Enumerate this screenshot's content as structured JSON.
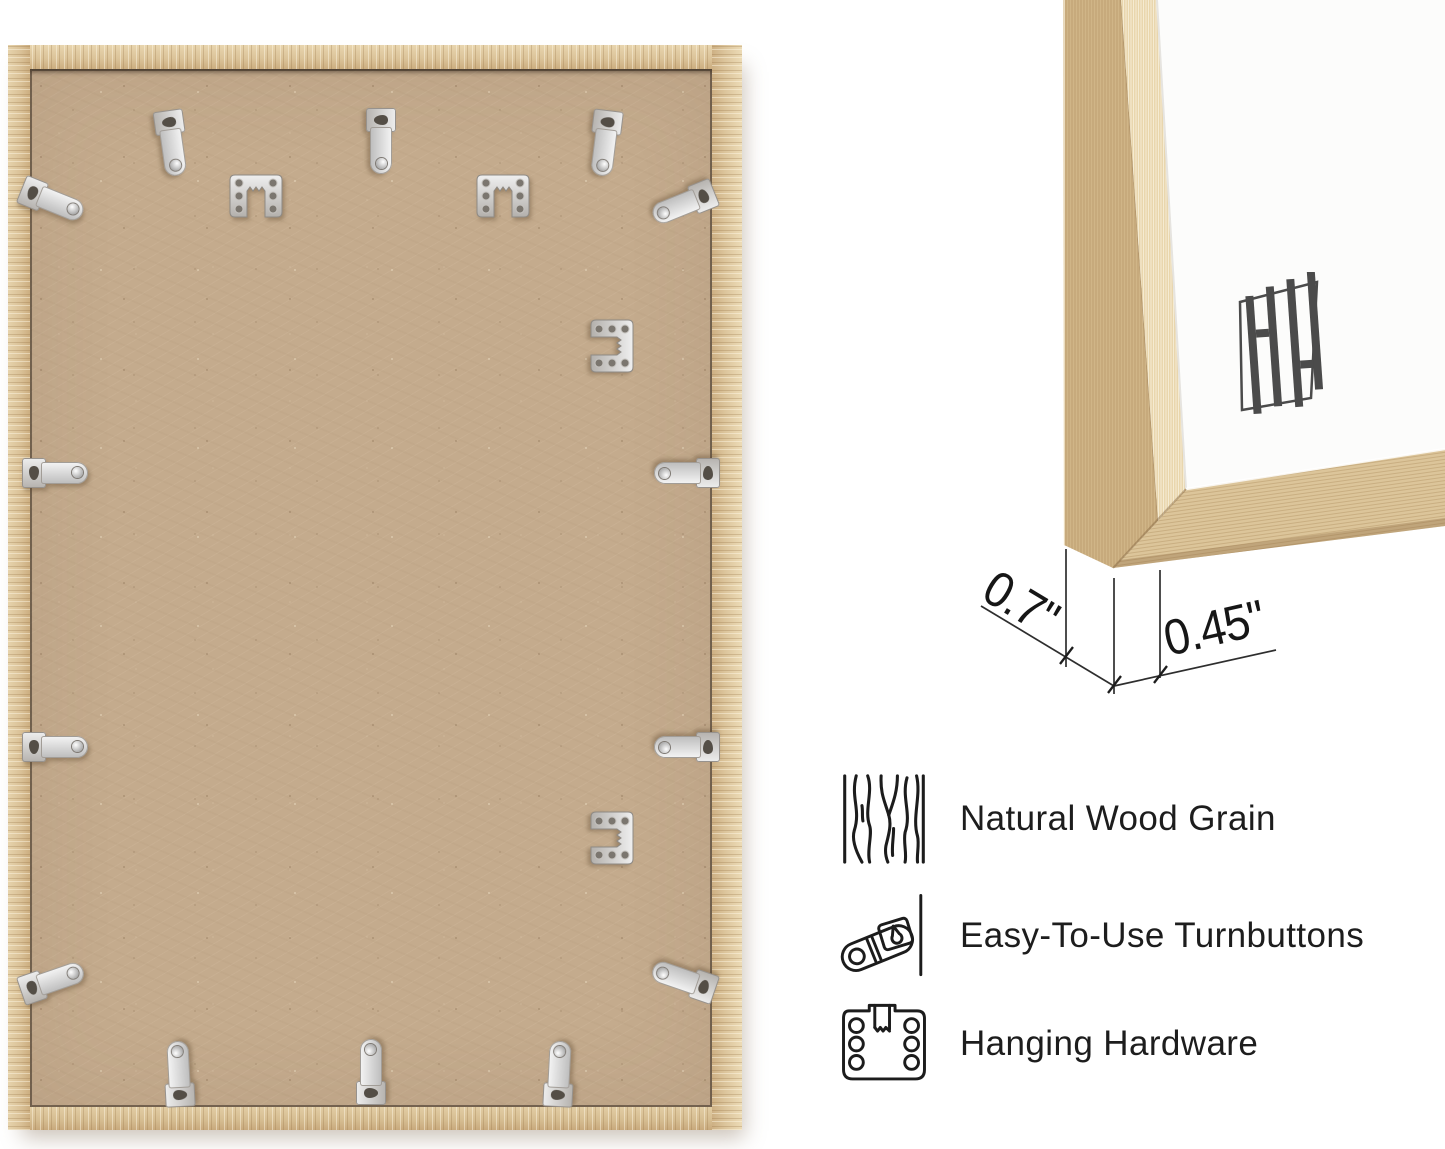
{
  "dimensions": {
    "frame_depth": "0.7\"",
    "frame_face_width": "0.45\""
  },
  "features": [
    {
      "icon": "wood-grain-icon",
      "label": "Natural Wood Grain"
    },
    {
      "icon": "turnbutton-icon",
      "label": "Easy-To-Use Turnbuttons"
    },
    {
      "icon": "hanging-hardware-icon",
      "label": "Hanging Hardware"
    }
  ],
  "brand": {
    "logo_icon": "hh-monogram-icon"
  },
  "hardware": {
    "turnbutton_count": 14,
    "hanging_hardware_count": 4
  },
  "colors": {
    "wood": "#dcc49c",
    "backing": "#c4ab8d",
    "metal": "#d9d9d9",
    "text": "#1d1d1d",
    "logo": "#4b4b4b",
    "background": "#ffffff"
  }
}
